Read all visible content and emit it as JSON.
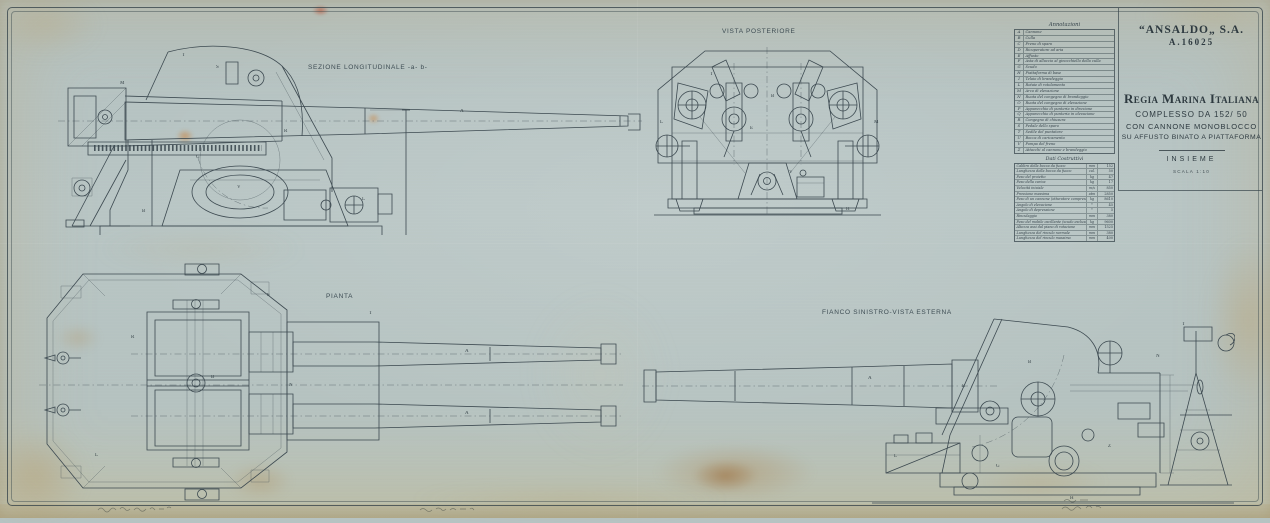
{
  "header": {
    "company": "“ANSALDO„ S.A.",
    "number": "A.16025"
  },
  "title_block": {
    "line1": "Regia Marina Italiana",
    "line2": "COMPLESSO DA 152/ 50",
    "line3": "CON CANNONE MONOBLOCCO",
    "line4": "SU AFFUSTO BINATO A PIATTAFORMA",
    "line5": "INSIEME",
    "line6": "SCALA 1:10"
  },
  "views": [
    {
      "id": "sezione-longitudinale",
      "label": "SEZIONE LONGITUDINALE -a- b-",
      "callouts": [
        {
          "t": "T",
          "x": 152,
          "y": 16
        },
        {
          "t": "S",
          "x": 186,
          "y": 28
        },
        {
          "t": "A",
          "x": 430,
          "y": 72
        },
        {
          "t": "R",
          "x": 254,
          "y": 92
        },
        {
          "t": "G",
          "x": 166,
          "y": 118
        },
        {
          "t": "V",
          "x": 207,
          "y": 148
        },
        {
          "t": "L",
          "x": 332,
          "y": 160
        },
        {
          "t": "B",
          "x": 112,
          "y": 172
        },
        {
          "t": "M",
          "x": 90,
          "y": 44
        }
      ]
    },
    {
      "id": "vista-posteriore",
      "label": "VISTA POSTERIORE",
      "callouts": [
        {
          "t": "B",
          "x": 121,
          "y": 52
        },
        {
          "t": "E",
          "x": 100,
          "y": 84
        },
        {
          "t": "T",
          "x": 60,
          "y": 30
        },
        {
          "t": "L",
          "x": 10,
          "y": 78
        },
        {
          "t": "M",
          "x": 224,
          "y": 78
        },
        {
          "t": "V",
          "x": 139,
          "y": 128
        },
        {
          "t": "H",
          "x": 196,
          "y": 165
        }
      ]
    },
    {
      "id": "pianta",
      "label": "PIANTA",
      "callouts": [
        {
          "t": "S",
          "x": 232,
          "y": 34
        },
        {
          "t": "T",
          "x": 334,
          "y": 52
        },
        {
          "t": "A",
          "x": 430,
          "y": 90
        },
        {
          "t": "A",
          "x": 430,
          "y": 152
        },
        {
          "t": "B",
          "x": 176,
          "y": 116
        },
        {
          "t": "R",
          "x": 96,
          "y": 76
        },
        {
          "t": "N",
          "x": 254,
          "y": 124
        },
        {
          "t": "L",
          "x": 60,
          "y": 194
        }
      ]
    },
    {
      "id": "fianco-sinistro",
      "label": "FIANCO SINISTRO-VISTA ESTERNA",
      "callouts": [
        {
          "t": "A",
          "x": 228,
          "y": 64
        },
        {
          "t": "E",
          "x": 322,
          "y": 72
        },
        {
          "t": "B",
          "x": 388,
          "y": 48
        },
        {
          "t": "Z",
          "x": 468,
          "y": 132
        },
        {
          "t": "G",
          "x": 356,
          "y": 152
        },
        {
          "t": "L",
          "x": 254,
          "y": 142
        },
        {
          "t": "T",
          "x": 542,
          "y": 10
        },
        {
          "t": "N",
          "x": 516,
          "y": 42
        },
        {
          "t": "H",
          "x": 430,
          "y": 184
        }
      ]
    }
  ],
  "legend": {
    "title": "Annotazioni",
    "items": [
      {
        "key": "A",
        "label": "Cannone"
      },
      {
        "key": "B",
        "label": "Culla"
      },
      {
        "key": "C",
        "label": "Freno di sparo"
      },
      {
        "key": "D",
        "label": "Ricuperatore ad aria"
      },
      {
        "key": "E",
        "label": "Affusto"
      },
      {
        "key": "F",
        "label": "Asta di allaccio al ginocchiello della culla"
      },
      {
        "key": "G",
        "label": "Scudo"
      },
      {
        "key": "H",
        "label": "Piattaforma di base"
      },
      {
        "key": "I",
        "label": "Telaio di brandeggio"
      },
      {
        "key": "L",
        "label": "Rotaie di rotolamento"
      },
      {
        "key": "M",
        "label": "Arco di elevazione"
      },
      {
        "key": "N",
        "label": "Ruota del congegno di brandeggio"
      },
      {
        "key": "O",
        "label": "Ruota del congegno di elevazione"
      },
      {
        "key": "P",
        "label": "Apparecchio di punteria in direzione"
      },
      {
        "key": "Q",
        "label": "Apparecchio di punteria in elevazione"
      },
      {
        "key": "R",
        "label": "Congegno di chiusura"
      },
      {
        "key": "S",
        "label": "Pedale dello sparo"
      },
      {
        "key": "T",
        "label": "Sedile del puntatore"
      },
      {
        "key": "U",
        "label": "Bocca di caricamento"
      },
      {
        "key": "V",
        "label": "Pompa del freno"
      },
      {
        "key": "Z",
        "label": "Attacchi al cannone e brandeggio"
      }
    ],
    "dati_title": "Dati Costruttivi",
    "dati": [
      {
        "label": "Calibro della bocca da fuoco",
        "unit": "mm",
        "value": "152"
      },
      {
        "label": "Lunghezza della bocca da fuoco",
        "unit": "cal.",
        "value": "50"
      },
      {
        "label": "Peso del proietto",
        "unit": "kg",
        "value": "47"
      },
      {
        "label": "Peso della carica",
        "unit": "kg",
        "value": "17"
      },
      {
        "label": "Velocità iniziale",
        "unit": "m/s",
        "value": "850"
      },
      {
        "label": "Pressione massima",
        "unit": "atm",
        "value": "2850"
      },
      {
        "label": "Peso di un cannone (otturatore compreso)",
        "unit": "kg",
        "value": "8610"
      },
      {
        "label": "Angolo di elevazione",
        "unit": "°",
        "value": "45"
      },
      {
        "label": "Angolo di depressione",
        "unit": "°",
        "value": "5"
      },
      {
        "label": "Rinculaggio",
        "unit": "mm",
        "value": "380"
      },
      {
        "label": "Peso del mobile oscillante (scudo escluso)",
        "unit": "kg",
        "value": "9600"
      },
      {
        "label": "Altezza assi dal piano di rotazione",
        "unit": "mm",
        "value": "1525"
      },
      {
        "label": "Lunghezza del rinculo normale",
        "unit": "mm",
        "value": "380"
      },
      {
        "label": "Lunghezza del rinculo massimo",
        "unit": "mm",
        "value": "400"
      }
    ]
  }
}
